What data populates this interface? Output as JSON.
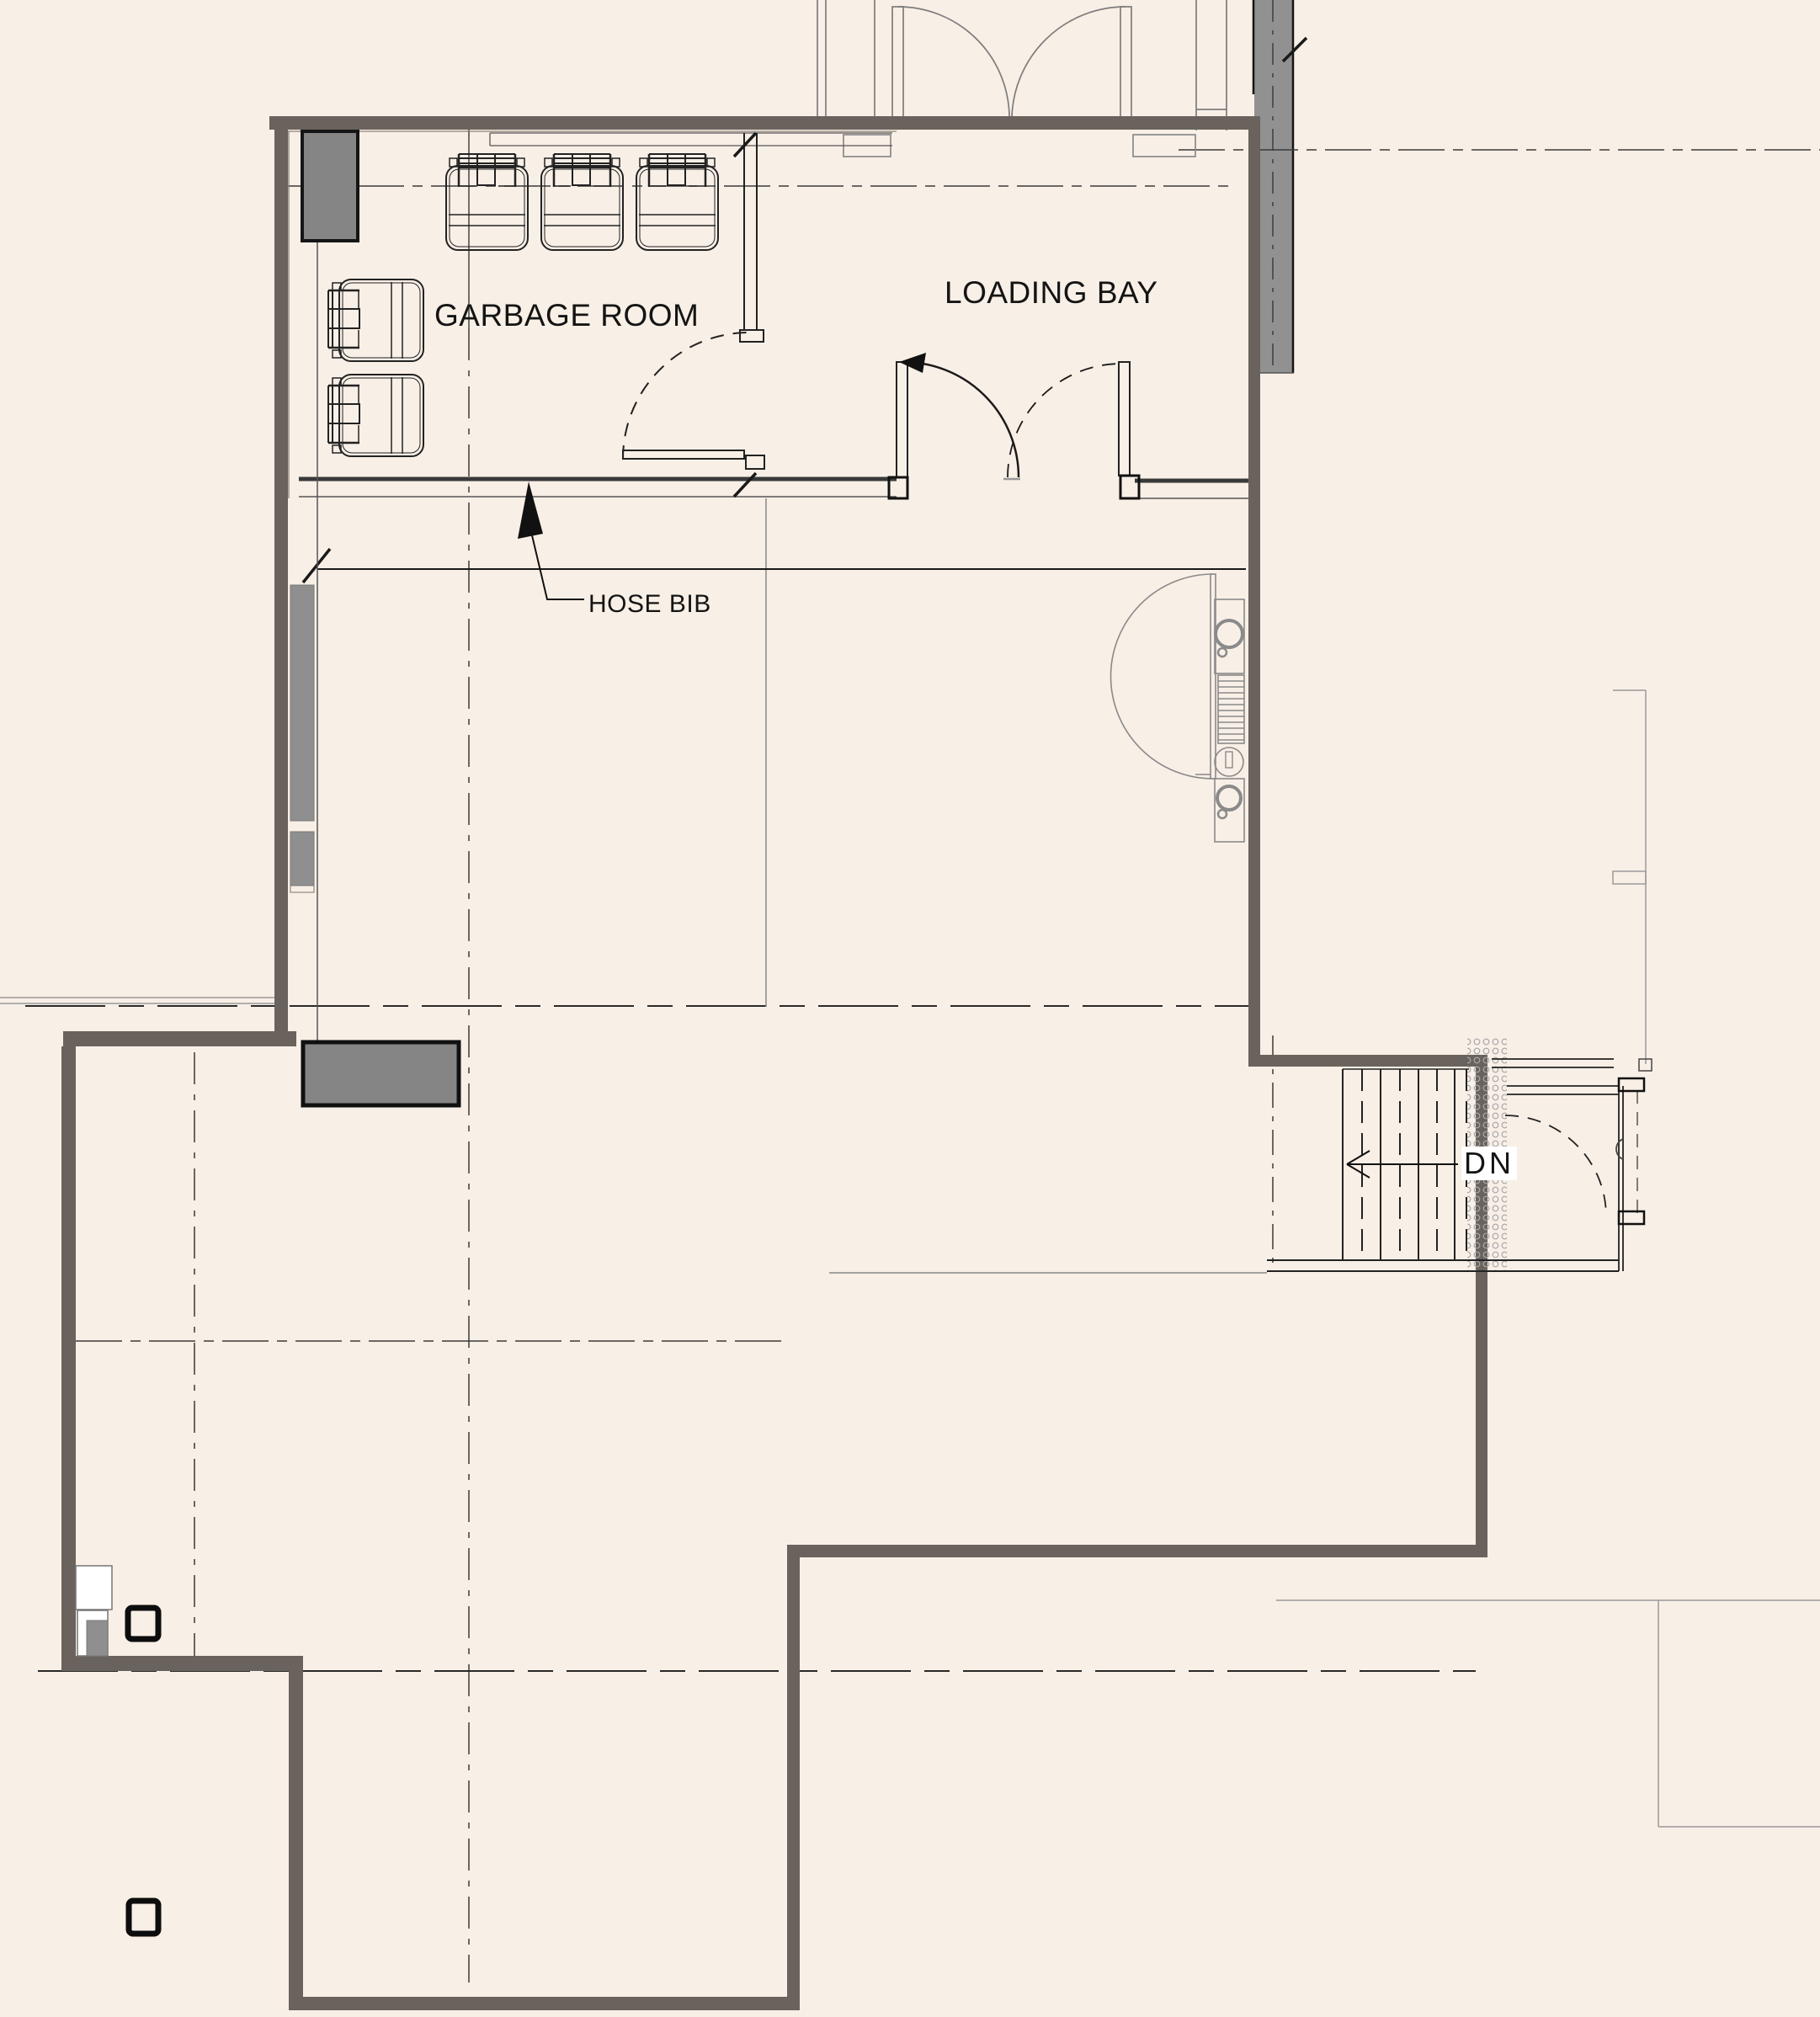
{
  "meta": {
    "drawing_type": "architectural floor plan (partial basement / service level)",
    "view": "plan"
  },
  "labels": {
    "garbage_room": "GARBAGE ROOM",
    "loading_bay": "LOADING BAY",
    "hose_bib": "HOSE BIB",
    "stair_down": "DN"
  },
  "rooms": [
    {
      "name": "GARBAGE ROOM"
    },
    {
      "name": "LOADING BAY"
    }
  ],
  "annotations": [
    {
      "type": "leader-note",
      "text": "HOSE BIB",
      "points_at": "garbage room south wall"
    },
    {
      "type": "stair-direction",
      "text": "DN",
      "direction": "left"
    }
  ],
  "symbols": {
    "garbage_bins_top_row": 3,
    "garbage_bins_left_column": 2,
    "double_door_sets": 2,
    "single_door_swings": 3,
    "column_markers": 2,
    "stair_risers": 8
  },
  "colors": {
    "background": "#f8efe6",
    "wall_poche": "#6a635d",
    "existing_gray_fill": "#8f8f8f",
    "shaft_fill": "#858585",
    "line_dark": "#1a1a1a",
    "line_medium": "#555555",
    "line_light": "#999999",
    "hatch_dot": "#a8a8a8"
  }
}
